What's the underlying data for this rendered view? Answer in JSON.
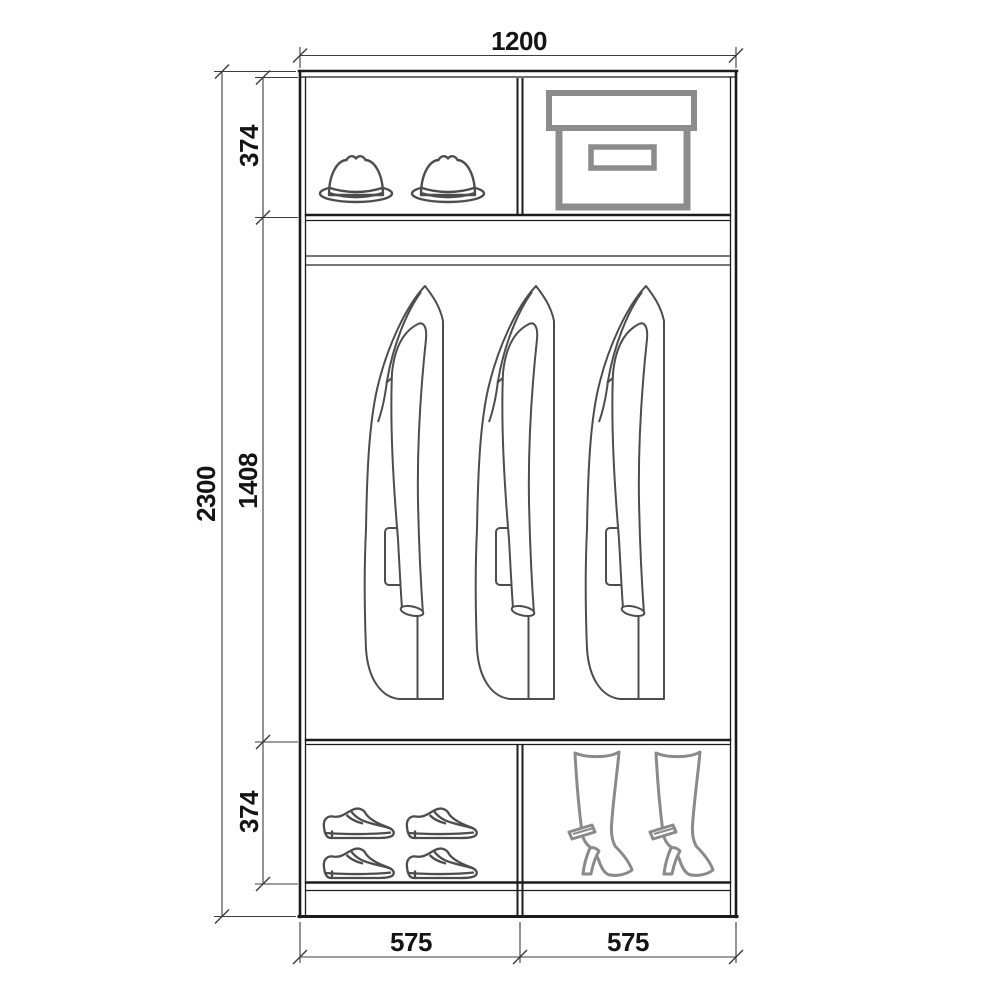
{
  "drawing": {
    "type": "wardrobe-interior-elevation",
    "labels": {
      "overall_width": "1200",
      "overall_height": "2300",
      "top_section_height": "374",
      "middle_section_height": "1408",
      "bottom_section_height": "374",
      "left_compartment_width": "575",
      "right_compartment_width": "575"
    },
    "compartments": {
      "top_left_icons": [
        "hat-icon",
        "hat-icon"
      ],
      "top_right_icons": [
        "storage-box-icon"
      ],
      "middle_icons": [
        "coat-icon",
        "coat-icon",
        "coat-icon"
      ],
      "bottom_left_icons": [
        "shoe-icon",
        "shoe-icon",
        "shoe-icon",
        "shoe-icon"
      ],
      "bottom_right_icons": [
        "boot-icon",
        "boot-icon"
      ]
    },
    "colors": {
      "cabinet_line": "#1c1c1c",
      "dimension_line": "#3c3c3c",
      "garment_line": "#4d4d4d",
      "box_line": "#8c8c8c",
      "boot_line": "#8a8a8a",
      "text": "#141414",
      "background": "#ffffff"
    }
  }
}
